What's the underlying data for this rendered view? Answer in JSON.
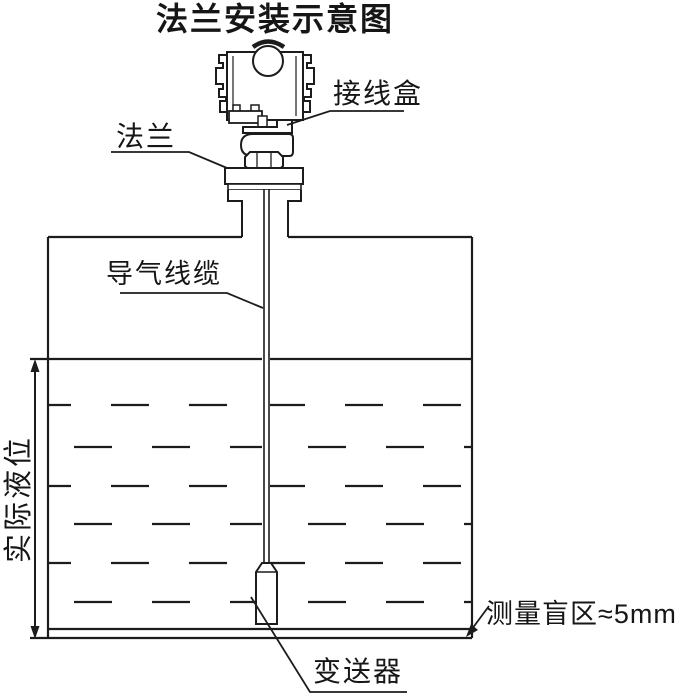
{
  "title": "法兰安装示意图",
  "labels": {
    "junction_box": "接线盒",
    "flange": "法兰",
    "air_cable": "导气线缆",
    "actual_level": "实际液位",
    "blind_zone": "测量盲区≈5mm",
    "transmitter": "变送器"
  },
  "colors": {
    "line": "#1c1c1c",
    "background": "#ffffff"
  }
}
